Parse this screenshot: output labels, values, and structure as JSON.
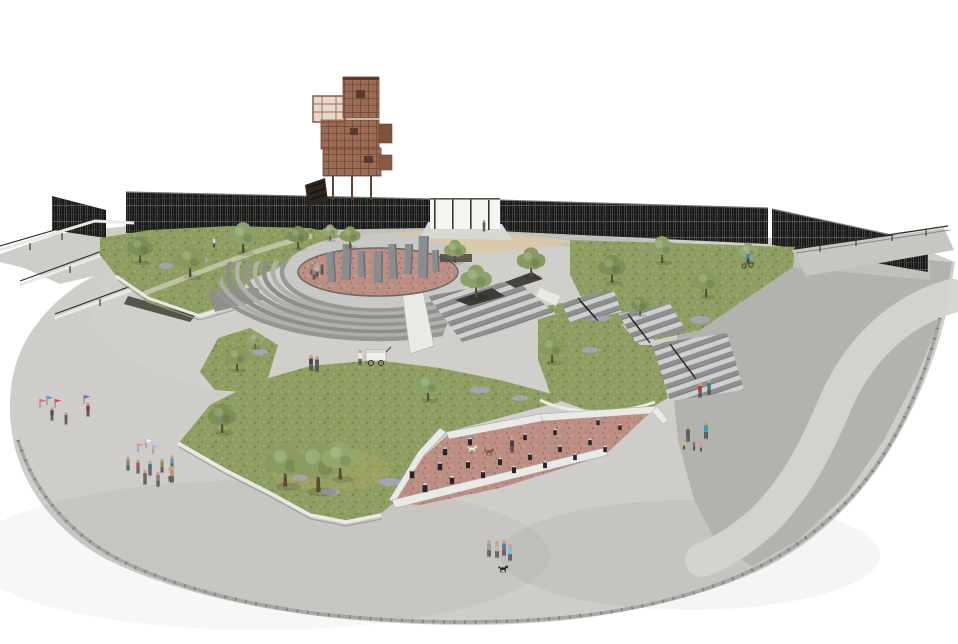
{
  "scene": {
    "title": "Aerial architectural rendering of an urban plaza park",
    "elements": {
      "tower": "corten-steel lookout tower with switchback stairs",
      "wall": "dark perforated screen wall along rear perimeter",
      "monolith_plaza": "oval red-gravel plaza with gray standing stones",
      "amphitheater": "curved radiating seat steps",
      "stairs": "cascading stair flights with black handrails",
      "dog_run": "red gravel dog run with black bollards",
      "lawns": "sloped lawns with olive trees and lavender shrubs",
      "plaza": "light concrete plaza with curved paver edge",
      "people": "flag performers, food-cart vendor, families, dog walkers, cyclist"
    },
    "counts": {
      "trees": 22,
      "standing_stones": 8,
      "bollards": 20,
      "stair_flights": 4,
      "people": 36,
      "dogs": 4,
      "flags": 7
    }
  },
  "palette": {
    "background": "#ffffff",
    "concrete_light": "#cecdc9",
    "concrete_mid": "#c0c0bc",
    "concrete_dark": "#b2b2ae",
    "path_light": "#d4d4d0",
    "curb": "#a6a6a2",
    "screen_wall": "#17171a",
    "tower_corten": "#9c6b53",
    "tower_shadow": "#734b39",
    "lawn": "#8e9e62",
    "lawn_shadow": "#79894e",
    "gravel_red": "#bd8e84",
    "step_face": "#8e8f93",
    "wall_trim": "#e9e9e5",
    "rail": "#2a2a28",
    "monolith": "#8a8d90",
    "tan_path": "#d9c9a8"
  }
}
